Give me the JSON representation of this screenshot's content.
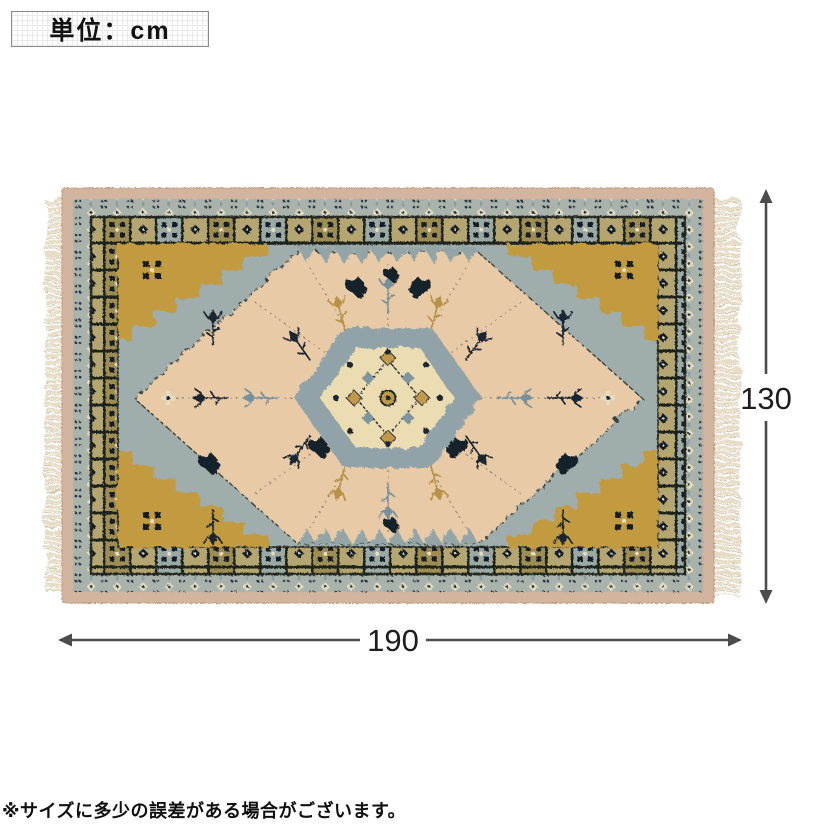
{
  "unit_box": {
    "label": "単位：cm"
  },
  "dimensions": {
    "width_value": "190",
    "height_value": "130",
    "unit": "cm"
  },
  "note": {
    "text": "※サイズに多少の誤差がある場合がございます。"
  },
  "colors": {
    "dimension_line": "#4c4c4c",
    "dimension_text": "#1d1d1d",
    "rug_edge_pink": "#d3b49e",
    "rug_band_blue": "#a9b3ac",
    "rug_band_olive": "#9d8d52",
    "rug_band_khaki": "#b4a571",
    "rug_field_blue": "#9fadac",
    "rug_diamond_peach": "#e8cba6",
    "rug_medallion_cream": "#ecdcb2",
    "rug_gold": "#c29a41",
    "rug_navy": "#131d28",
    "fringe_cream": "#e7ddc6"
  }
}
